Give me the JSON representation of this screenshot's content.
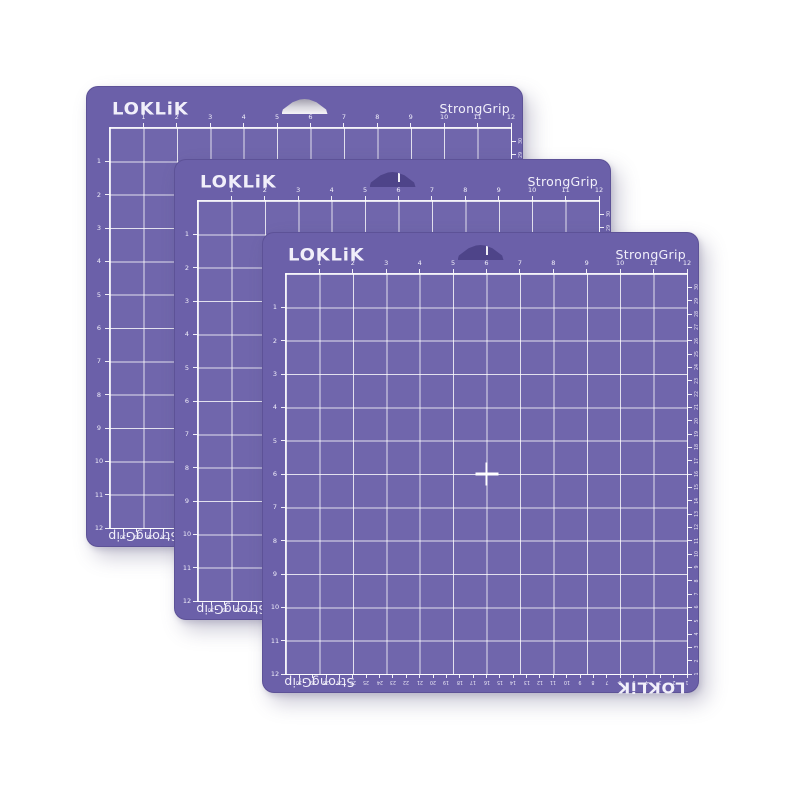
{
  "page": {
    "background": "#ffffff"
  },
  "product": {
    "name": "LOKLiK StrongGrip cutting mat set",
    "mat_count": 3
  },
  "mat": {
    "brand_logo": "LOKLiK",
    "grip_label": "StrongGrip",
    "inch_numbers": [
      1,
      2,
      3,
      4,
      5,
      6,
      7,
      8,
      9,
      10,
      11,
      12
    ],
    "cm_numbers": [
      30,
      29,
      28,
      27,
      26,
      25,
      24,
      23,
      22,
      21,
      20,
      19,
      18,
      17,
      16,
      15,
      14,
      13,
      12,
      11,
      10,
      9,
      8,
      7,
      6,
      5,
      4,
      3,
      2,
      1
    ],
    "grid": {
      "columns": 12,
      "rows": 12
    },
    "colors": {
      "mat_purple": "#6b60a9",
      "hole_shadow_purple": "#4e4489",
      "grid_line_white": "#ffffff",
      "label_white": "#f1effa",
      "hole_backlight_gray": "#d8d7de"
    }
  }
}
